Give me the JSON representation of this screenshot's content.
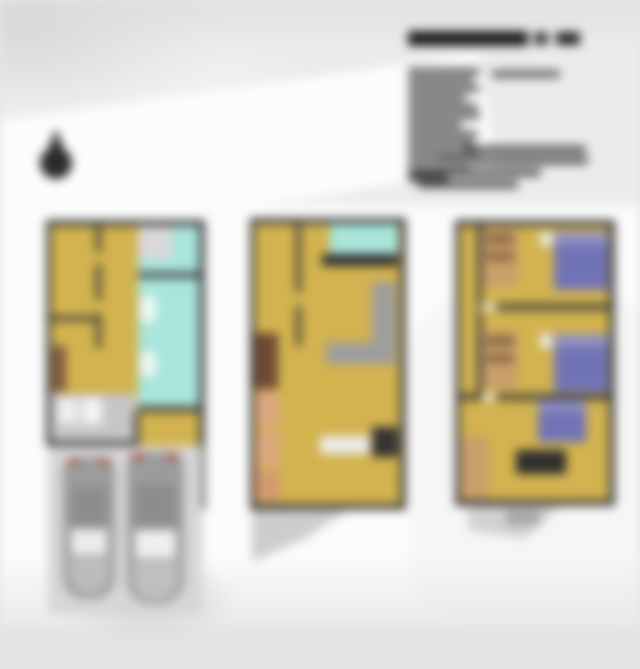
{
  "meta": {
    "canvas_width": 640,
    "canvas_height": 669,
    "blur_px": 5,
    "content_kind": "blurred architectural floor plan sheet with three stacked-level plans, title block and north arrow"
  },
  "palette": {
    "background": "#e9e9e9",
    "paper_white": "#fbfbfb",
    "wall_dark": "#3c3c3c",
    "floor_yellow": "#d2b34f",
    "bath_cyan": "#a9e5dc",
    "bed_purple": "#7173b7",
    "furniture_tan": "#dba87d",
    "furniture_wood": "#c9a06a",
    "sofa_gray": "#9e9e9e",
    "car_gray": "#9c9c9c",
    "taillight_red": "#b04840",
    "title_ink": "#1c1c1c",
    "body_ink": "#4e4e4e"
  },
  "compass": {
    "name": "north-arrow-icon",
    "circle": {
      "x": 40,
      "y": 147,
      "w": 32,
      "h": 32,
      "c": "#2a2a2a"
    },
    "pointer": {
      "x": 46,
      "y": 128,
      "w": 20,
      "h": 22,
      "c": "#333333"
    }
  },
  "title_block": {
    "title_segments": [
      {
        "name": "title-text-blur",
        "x": 408,
        "y": 31,
        "w": 120,
        "h": 15,
        "c": "#1c1c1c"
      },
      {
        "name": "title-text-blur",
        "x": 534,
        "y": 32,
        "w": 14,
        "h": 13,
        "c": "#3a3a3a"
      },
      {
        "name": "title-text-blur",
        "x": 556,
        "y": 32,
        "w": 24,
        "h": 13,
        "c": "#262626"
      }
    ],
    "right_line": {
      "name": "subtitle-line-blur",
      "x": 492,
      "y": 70,
      "w": 68,
      "h": 8,
      "c": "#6a6a6a"
    },
    "left_column": {
      "x": 408,
      "start_y": 68,
      "line_h": 6,
      "gap": 3,
      "c": "#4e4e4e",
      "widths": [
        72,
        66,
        72,
        58,
        70,
        72,
        54,
        70,
        66,
        72,
        56,
        62,
        40
      ]
    },
    "lower_lines": [
      {
        "name": "paragraph-line-blur",
        "x": 464,
        "y": 146,
        "w": 122,
        "h": 7,
        "c": "#4a4a4a"
      },
      {
        "name": "paragraph-line-blur",
        "x": 436,
        "y": 157,
        "w": 152,
        "h": 7,
        "c": "#4a4a4a"
      },
      {
        "name": "paragraph-line-blur",
        "x": 409,
        "y": 169,
        "w": 132,
        "h": 7,
        "c": "#4a4a4a"
      },
      {
        "name": "paragraph-line-blur",
        "x": 418,
        "y": 181,
        "w": 100,
        "h": 7,
        "c": "#4a4a4a"
      }
    ]
  },
  "scene": {
    "shapes": [
      {
        "name": "plan1-floor-yellow",
        "x": 50,
        "y": 225,
        "w": 150,
        "h": 218,
        "c": "#d2b34f"
      },
      {
        "name": "plan1-room-top-right",
        "x": 138,
        "y": 225,
        "w": 62,
        "h": 50,
        "c": "#d9d9d9"
      },
      {
        "name": "plan1-closet-cyan",
        "x": 172,
        "y": 225,
        "w": 28,
        "h": 34,
        "c": "#a9e5dc"
      },
      {
        "name": "plan1-bathroom-cyan",
        "x": 138,
        "y": 259,
        "w": 62,
        "h": 150,
        "c": "#a9e5dc"
      },
      {
        "name": "plan1-bath-fixture",
        "x": 140,
        "y": 296,
        "w": 16,
        "h": 26,
        "c": "#eef7f4"
      },
      {
        "name": "plan1-bath-fixture",
        "x": 140,
        "y": 352,
        "w": 16,
        "h": 24,
        "c": "#eef7f4"
      },
      {
        "name": "plan1-garage-floor",
        "x": 50,
        "y": 394,
        "w": 86,
        "h": 50,
        "c": "#c6c6c6"
      },
      {
        "name": "plan1-appliance",
        "x": 58,
        "y": 398,
        "w": 20,
        "h": 26,
        "c": "#efefef"
      },
      {
        "name": "plan1-appliance",
        "x": 82,
        "y": 398,
        "w": 20,
        "h": 26,
        "c": "#f4f4f4"
      },
      {
        "name": "plan1-cabinet-brown",
        "x": 52,
        "y": 346,
        "w": 14,
        "h": 46,
        "c": "#7d5b40"
      },
      {
        "name": "plan1-wing-floor-yellow",
        "x": 138,
        "y": 412,
        "w": 62,
        "h": 92,
        "c": "#d2b34f"
      },
      {
        "name": "plan1-wall",
        "x": 46,
        "y": 220,
        "w": 158,
        "h": 6,
        "c": "#3c3c3c"
      },
      {
        "name": "plan1-wall",
        "x": 46,
        "y": 220,
        "w": 5,
        "h": 226,
        "c": "#3c3c3c"
      },
      {
        "name": "plan1-wall",
        "x": 199,
        "y": 220,
        "w": 6,
        "h": 290,
        "c": "#3c3c3c"
      },
      {
        "name": "plan1-wall",
        "x": 96,
        "y": 226,
        "w": 5,
        "h": 26,
        "c": "#3c3c3c"
      },
      {
        "name": "plan1-wall",
        "x": 96,
        "y": 264,
        "w": 5,
        "h": 36,
        "c": "#3c3c3c"
      },
      {
        "name": "plan1-wall",
        "x": 96,
        "y": 314,
        "w": 5,
        "h": 34,
        "c": "#3c3c3c"
      },
      {
        "name": "plan1-wall",
        "x": 50,
        "y": 316,
        "w": 46,
        "h": 5,
        "c": "#3c3c3c"
      },
      {
        "name": "plan1-wall",
        "x": 138,
        "y": 272,
        "w": 62,
        "h": 6,
        "c": "#3c3c3c"
      },
      {
        "name": "plan1-wall",
        "x": 138,
        "y": 406,
        "w": 66,
        "h": 6,
        "c": "#3c3c3c"
      },
      {
        "name": "plan1-wall",
        "x": 46,
        "y": 441,
        "w": 92,
        "h": 5,
        "c": "#3c3c3c"
      },
      {
        "name": "plan1-wall",
        "x": 134,
        "y": 412,
        "w": 5,
        "h": 96,
        "c": "#3c3c3c"
      },
      {
        "name": "plan1-wall",
        "x": 134,
        "y": 503,
        "w": 70,
        "h": 6,
        "c": "#3c3c3c"
      },
      {
        "name": "driveway",
        "x": 48,
        "y": 446,
        "w": 154,
        "h": 168,
        "c": "#d6d6d6"
      },
      {
        "name": "car-body",
        "x": 63,
        "y": 457,
        "w": 52,
        "h": 142,
        "c": "#9c9c9c",
        "rad": "14px 14px 22px 22px"
      },
      {
        "name": "car-taillight",
        "x": 67,
        "y": 459,
        "w": 12,
        "h": 5,
        "c": "#b04840"
      },
      {
        "name": "car-taillight",
        "x": 99,
        "y": 459,
        "w": 12,
        "h": 5,
        "c": "#b04840"
      },
      {
        "name": "car-roof",
        "x": 71,
        "y": 487,
        "w": 36,
        "h": 40,
        "c": "#8d8d8d"
      },
      {
        "name": "car-windshield",
        "x": 71,
        "y": 529,
        "w": 36,
        "h": 26,
        "c": "#ececec"
      },
      {
        "name": "car-hood",
        "x": 69,
        "y": 557,
        "w": 40,
        "h": 36,
        "c": "#bcbcbc",
        "rad": "0 0 18px 18px"
      },
      {
        "name": "car-body",
        "x": 127,
        "y": 452,
        "w": 57,
        "h": 152,
        "c": "#9c9c9c",
        "rad": "14px 14px 24px 24px"
      },
      {
        "name": "car-taillight",
        "x": 131,
        "y": 454,
        "w": 13,
        "h": 5,
        "c": "#b04840"
      },
      {
        "name": "car-taillight",
        "x": 166,
        "y": 454,
        "w": 13,
        "h": 5,
        "c": "#b04840"
      },
      {
        "name": "car-roof",
        "x": 135,
        "y": 484,
        "w": 41,
        "h": 44,
        "c": "#8d8d8d"
      },
      {
        "name": "car-windshield",
        "x": 135,
        "y": 530,
        "w": 41,
        "h": 28,
        "c": "#efefef"
      },
      {
        "name": "car-hood",
        "x": 133,
        "y": 560,
        "w": 45,
        "h": 40,
        "c": "#bfbfbf",
        "rad": "0 0 20px 20px"
      },
      {
        "name": "plan2-floor-yellow",
        "x": 252,
        "y": 222,
        "w": 152,
        "h": 284,
        "c": "#d2b34f"
      },
      {
        "name": "plan2-bath-cyan",
        "x": 330,
        "y": 224,
        "w": 68,
        "h": 30,
        "c": "#a9e5dc"
      },
      {
        "name": "plan2-counter-dark",
        "x": 322,
        "y": 254,
        "w": 76,
        "h": 12,
        "c": "#2f2f2f"
      },
      {
        "name": "plan2-sofa",
        "x": 372,
        "y": 282,
        "w": 24,
        "h": 62,
        "c": "#9e9e9e"
      },
      {
        "name": "plan2-sofa",
        "x": 326,
        "y": 342,
        "w": 70,
        "h": 22,
        "c": "#9e9e9e"
      },
      {
        "name": "plan2-cabinet-darkbrown",
        "x": 254,
        "y": 333,
        "w": 24,
        "h": 56,
        "c": "#6f4a33"
      },
      {
        "name": "plan2-cabinet-tan",
        "x": 254,
        "y": 392,
        "w": 26,
        "h": 36,
        "c": "#dba87d"
      },
      {
        "name": "plan2-cabinet-tan",
        "x": 254,
        "y": 432,
        "w": 26,
        "h": 34,
        "c": "#dba87d"
      },
      {
        "name": "plan2-cabinet-tan",
        "x": 254,
        "y": 470,
        "w": 26,
        "h": 32,
        "c": "#d49a6f"
      },
      {
        "name": "plan2-table-white",
        "x": 320,
        "y": 436,
        "w": 50,
        "h": 18,
        "c": "#ebebeb"
      },
      {
        "name": "plan2-unit-dark",
        "x": 372,
        "y": 427,
        "w": 26,
        "h": 30,
        "c": "#333333"
      },
      {
        "name": "plan2-wall",
        "x": 250,
        "y": 218,
        "w": 156,
        "h": 6,
        "c": "#3c3c3c"
      },
      {
        "name": "plan2-wall",
        "x": 250,
        "y": 218,
        "w": 5,
        "h": 292,
        "c": "#3c3c3c"
      },
      {
        "name": "plan2-wall",
        "x": 400,
        "y": 218,
        "w": 6,
        "h": 292,
        "c": "#3c3c3c"
      },
      {
        "name": "plan2-wall",
        "x": 250,
        "y": 504,
        "w": 156,
        "h": 6,
        "c": "#3c3c3c"
      },
      {
        "name": "plan2-wall",
        "x": 296,
        "y": 224,
        "w": 5,
        "h": 68,
        "c": "#3c3c3c"
      },
      {
        "name": "plan2-wall",
        "x": 296,
        "y": 306,
        "w": 5,
        "h": 40,
        "c": "#3c3c3c"
      },
      {
        "name": "plan2-entry-steps",
        "x": 252,
        "y": 510,
        "w": 96,
        "h": 52,
        "c": "#cdcdcd",
        "clip": "polygon(0 0,100% 0,55% 55%,0 100%)"
      },
      {
        "name": "plan3-floor-yellow",
        "x": 457,
        "y": 224,
        "w": 154,
        "h": 278,
        "c": "#d2b34f"
      },
      {
        "name": "plan3-dresser",
        "x": 482,
        "y": 228,
        "w": 36,
        "h": 58,
        "c": "#c9a06a"
      },
      {
        "name": "plan3-dresser-stripe",
        "x": 486,
        "y": 234,
        "w": 28,
        "h": 10,
        "c": "#8a6844"
      },
      {
        "name": "plan3-dresser-stripe",
        "x": 486,
        "y": 252,
        "w": 28,
        "h": 9,
        "c": "#8a6844"
      },
      {
        "name": "plan3-nightstand",
        "x": 540,
        "y": 232,
        "w": 12,
        "h": 14,
        "c": "#ececec"
      },
      {
        "name": "plan3-bed",
        "x": 554,
        "y": 232,
        "w": 54,
        "h": 58,
        "c": "#7173b7"
      },
      {
        "name": "plan3-bed-pillow",
        "x": 554,
        "y": 232,
        "w": 54,
        "h": 13,
        "c": "#8f90c4"
      },
      {
        "name": "plan3-dresser",
        "x": 482,
        "y": 330,
        "w": 36,
        "h": 58,
        "c": "#c9a06a"
      },
      {
        "name": "plan3-dresser-stripe",
        "x": 486,
        "y": 336,
        "w": 28,
        "h": 10,
        "c": "#8a6844"
      },
      {
        "name": "plan3-dresser-stripe",
        "x": 486,
        "y": 354,
        "w": 28,
        "h": 9,
        "c": "#8a6844"
      },
      {
        "name": "plan3-nightstand",
        "x": 540,
        "y": 334,
        "w": 12,
        "h": 14,
        "c": "#ececec"
      },
      {
        "name": "plan3-bed",
        "x": 554,
        "y": 334,
        "w": 54,
        "h": 58,
        "c": "#7173b7"
      },
      {
        "name": "plan3-bed-pillow",
        "x": 554,
        "y": 334,
        "w": 54,
        "h": 13,
        "c": "#8f90c4"
      },
      {
        "name": "plan3-wardrobe-tan",
        "x": 459,
        "y": 436,
        "w": 30,
        "h": 64,
        "c": "#c9a06a"
      },
      {
        "name": "plan3-bed",
        "x": 538,
        "y": 400,
        "w": 48,
        "h": 42,
        "c": "#7173b7"
      },
      {
        "name": "plan3-bed-pillow",
        "x": 538,
        "y": 400,
        "w": 48,
        "h": 11,
        "c": "#8f90c4"
      },
      {
        "name": "plan3-desk-dark",
        "x": 516,
        "y": 450,
        "w": 50,
        "h": 24,
        "c": "#2f2f2f"
      },
      {
        "name": "plan3-wall",
        "x": 455,
        "y": 220,
        "w": 160,
        "h": 6,
        "c": "#3c3c3c"
      },
      {
        "name": "plan3-wall",
        "x": 455,
        "y": 220,
        "w": 5,
        "h": 286,
        "c": "#3c3c3c"
      },
      {
        "name": "plan3-wall",
        "x": 609,
        "y": 220,
        "w": 6,
        "h": 286,
        "c": "#3c3c3c"
      },
      {
        "name": "plan3-wall",
        "x": 455,
        "y": 500,
        "w": 160,
        "h": 6,
        "c": "#3c3c3c"
      },
      {
        "name": "plan3-wall",
        "x": 478,
        "y": 304,
        "w": 137,
        "h": 6,
        "c": "#3c3c3c"
      },
      {
        "name": "plan3-wall",
        "x": 455,
        "y": 394,
        "w": 160,
        "h": 6,
        "c": "#3c3c3c"
      },
      {
        "name": "plan3-wall",
        "x": 477,
        "y": 226,
        "w": 5,
        "h": 78,
        "c": "#3c3c3c"
      },
      {
        "name": "plan3-wall",
        "x": 477,
        "y": 312,
        "w": 5,
        "h": 82,
        "c": "#3c3c3c"
      },
      {
        "name": "plan3-door-gap",
        "x": 482,
        "y": 304,
        "w": 14,
        "h": 6,
        "c": "#f2f2f2"
      },
      {
        "name": "plan3-door-gap",
        "x": 482,
        "y": 394,
        "w": 14,
        "h": 6,
        "c": "#f2f2f2"
      },
      {
        "name": "plan3-entry-steps",
        "x": 468,
        "y": 506,
        "w": 92,
        "h": 44,
        "c": "#d2d2d2",
        "clip": "polygon(0 0,100% 0,62% 75%,0 55%)"
      },
      {
        "name": "plan3-step-block",
        "x": 506,
        "y": 510,
        "w": 34,
        "h": 15,
        "c": "#a6a6a6"
      }
    ]
  }
}
